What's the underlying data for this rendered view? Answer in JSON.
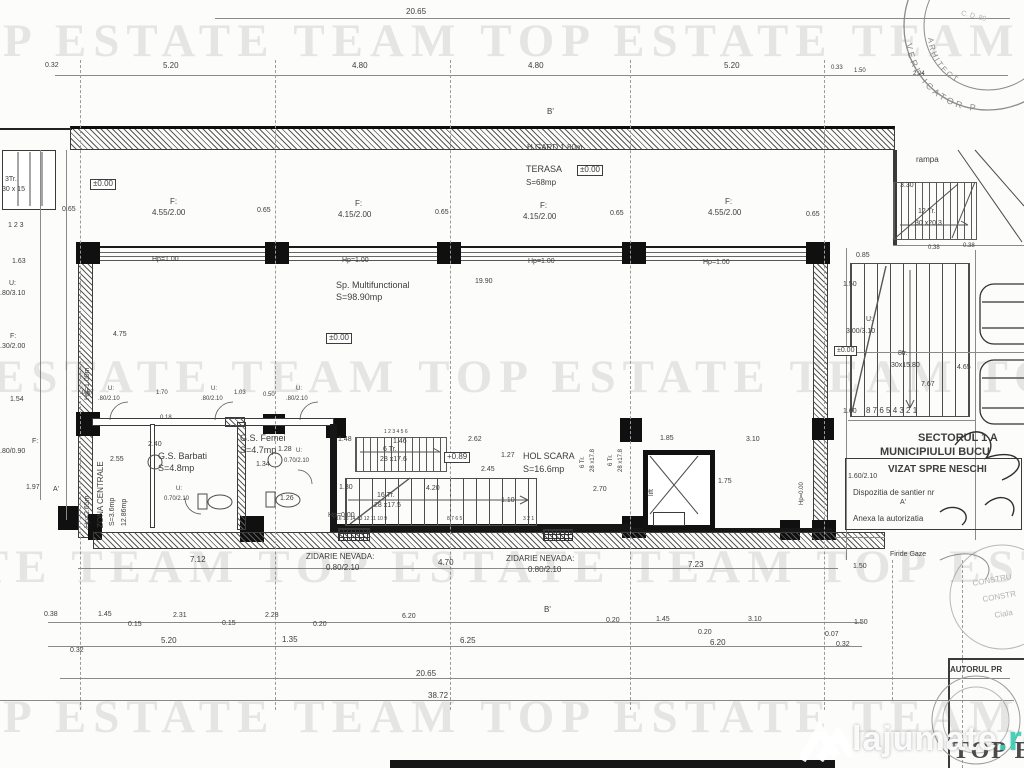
{
  "watermark": {
    "row": "TOP ESTATE TEAM   TOP ESTATE TEAM   TOP ESTATE TEAM",
    "color": "#6e6e6e"
  },
  "footer": {
    "name": "lajumate",
    "tld": ".ro",
    "accent": "#3ad0b8"
  },
  "stamp": {
    "arc1": "VERIFICATOR P",
    "arc2": "ARHITECT",
    "top_note": "C. D. 89"
  },
  "labels": [
    {
      "t": "20.65",
      "x": 406,
      "y": 8
    },
    {
      "t": "0.32",
      "x": 45,
      "y": 62,
      "s": 7
    },
    {
      "t": "5.20",
      "x": 163,
      "y": 62
    },
    {
      "t": "4.80",
      "x": 352,
      "y": 62
    },
    {
      "t": "4.80",
      "x": 528,
      "y": 62
    },
    {
      "t": "5.20",
      "x": 724,
      "y": 62
    },
    {
      "t": "0.33",
      "x": 831,
      "y": 65,
      "s": 6
    },
    {
      "t": "1.50",
      "x": 854,
      "y": 68,
      "s": 6
    },
    {
      "t": "2.24",
      "x": 913,
      "y": 71,
      "s": 6
    },
    {
      "t": "B'",
      "x": 547,
      "y": 108,
      "n": "section-marker-b"
    },
    {
      "t": "H GARD 1.80m",
      "x": 527,
      "y": 144,
      "n": "label-h-gard"
    },
    {
      "t": "TERASA",
      "x": 526,
      "y": 165,
      "s": 9,
      "n": "room-label-terasa"
    },
    {
      "t": "±0.00",
      "x": 577,
      "y": 165,
      "b": 1
    },
    {
      "t": "S=68mp",
      "x": 526,
      "y": 179
    },
    {
      "t": "rampa",
      "x": 916,
      "y": 156,
      "n": "room-label-rampa"
    },
    {
      "t": "3.30",
      "x": 900,
      "y": 182,
      "s": 7
    },
    {
      "t": "12 Tr.",
      "x": 918,
      "y": 208,
      "s": 7
    },
    {
      "t": "30 x20.3",
      "x": 915,
      "y": 220,
      "s": 7
    },
    {
      "t": "0.38",
      "x": 928,
      "y": 245,
      "s": 6
    },
    {
      "t": "0.38",
      "x": 963,
      "y": 243,
      "s": 6
    },
    {
      "t": "3Tr.",
      "x": 5,
      "y": 176,
      "s": 7
    },
    {
      "t": "30 x 15",
      "x": 2,
      "y": 186,
      "s": 7
    },
    {
      "t": "1  2  3",
      "x": 8,
      "y": 222,
      "s": 7,
      "n": "grid-axis-numbers"
    },
    {
      "t": "1.63",
      "x": 12,
      "y": 258,
      "s": 7
    },
    {
      "t": "±0.00",
      "x": 90,
      "y": 179,
      "b": 1
    },
    {
      "t": "U:",
      "x": 9,
      "y": 280,
      "s": 7
    },
    {
      "t": ".80/3.10",
      "x": 0,
      "y": 290,
      "s": 7
    },
    {
      "t": "F:",
      "x": 10,
      "y": 333,
      "s": 7
    },
    {
      "t": ".30/2.00",
      "x": 0,
      "y": 343,
      "s": 7
    },
    {
      "t": "1.54",
      "x": 10,
      "y": 396,
      "s": 7
    },
    {
      "t": "F:",
      "x": 32,
      "y": 438,
      "s": 7
    },
    {
      "t": ".80/0.90",
      "x": 0,
      "y": 448,
      "s": 7
    },
    {
      "t": "1.97",
      "x": 26,
      "y": 484,
      "s": 7
    },
    {
      "t": "A'",
      "x": 53,
      "y": 486,
      "s": 7,
      "n": "section-marker-a"
    },
    {
      "t": "0.65",
      "x": 62,
      "y": 206,
      "s": 7
    },
    {
      "t": "F:",
      "x": 170,
      "y": 198
    },
    {
      "t": "4.55/2.00",
      "x": 152,
      "y": 209
    },
    {
      "t": "0.65",
      "x": 257,
      "y": 207,
      "s": 7
    },
    {
      "t": "F:",
      "x": 355,
      "y": 200
    },
    {
      "t": "4.15/2.00",
      "x": 338,
      "y": 211
    },
    {
      "t": "0.65",
      "x": 435,
      "y": 209,
      "s": 7
    },
    {
      "t": "F:",
      "x": 540,
      "y": 202
    },
    {
      "t": "4.15/2.00",
      "x": 523,
      "y": 213
    },
    {
      "t": "0.65",
      "x": 610,
      "y": 210,
      "s": 7
    },
    {
      "t": "F:",
      "x": 725,
      "y": 198
    },
    {
      "t": "4.55/2.00",
      "x": 708,
      "y": 209
    },
    {
      "t": "0.65",
      "x": 806,
      "y": 211,
      "s": 7
    },
    {
      "t": "Hp=1.00",
      "x": 152,
      "y": 256,
      "s": 7
    },
    {
      "t": "Hp=1.00",
      "x": 342,
      "y": 257,
      "s": 7
    },
    {
      "t": "Hp=1.00",
      "x": 528,
      "y": 258,
      "s": 7
    },
    {
      "t": "Hp=1.00",
      "x": 703,
      "y": 259,
      "s": 7
    },
    {
      "t": "19.90",
      "x": 475,
      "y": 278,
      "s": 7
    },
    {
      "t": "Sp. Multifunctional",
      "x": 336,
      "y": 281,
      "s": 9,
      "n": "room-label-multifunctional"
    },
    {
      "t": "S=98.90mp",
      "x": 336,
      "y": 293,
      "s": 9
    },
    {
      "t": "±0.00",
      "x": 326,
      "y": 333,
      "b": 1
    },
    {
      "t": "4.75",
      "x": 113,
      "y": 331,
      "s": 7
    },
    {
      "t": "Hp=1.00m",
      "x": 84,
      "y": 400,
      "r": -90,
      "s": 7
    },
    {
      "t": "0.85",
      "x": 856,
      "y": 252,
      "s": 7
    },
    {
      "t": "1.50",
      "x": 843,
      "y": 281,
      "s": 7
    },
    {
      "t": "U:",
      "x": 866,
      "y": 316,
      "s": 7
    },
    {
      "t": "3.00/3.10",
      "x": 846,
      "y": 328,
      "s": 7
    },
    {
      "t": "±0.00",
      "x": 834,
      "y": 346,
      "b": 1,
      "s": 7
    },
    {
      "t": "8tr.",
      "x": 898,
      "y": 350,
      "s": 7
    },
    {
      "t": "30x15.80",
      "x": 891,
      "y": 362,
      "s": 7
    },
    {
      "t": "4.65",
      "x": 957,
      "y": 364,
      "s": 7
    },
    {
      "t": "7.67",
      "x": 921,
      "y": 381,
      "s": 7
    },
    {
      "t": "1.60",
      "x": 843,
      "y": 408,
      "s": 7
    },
    {
      "t": "8 7 6  5 4 3 2 1",
      "x": 866,
      "y": 407,
      "n": "stair-tread-numbers"
    },
    {
      "t": "0.67",
      "x": 82,
      "y": 390,
      "s": 6
    },
    {
      "t": "U:",
      "x": 108,
      "y": 386,
      "s": 6
    },
    {
      "t": ".80/2.10",
      "x": 98,
      "y": 396,
      "s": 6
    },
    {
      "t": "1.70",
      "x": 156,
      "y": 390,
      "s": 6
    },
    {
      "t": "U:",
      "x": 211,
      "y": 386,
      "s": 6
    },
    {
      "t": ".80/2.10",
      "x": 201,
      "y": 396,
      "s": 6
    },
    {
      "t": "1.03",
      "x": 234,
      "y": 390,
      "s": 6
    },
    {
      "t": "0.50",
      "x": 263,
      "y": 392,
      "s": 6
    },
    {
      "t": "U:",
      "x": 296,
      "y": 386,
      "s": 6
    },
    {
      "t": ".80/2.10",
      "x": 286,
      "y": 396,
      "s": 6
    },
    {
      "t": "0.18",
      "x": 160,
      "y": 415,
      "s": 6
    },
    {
      "t": "2.40",
      "x": 148,
      "y": 441,
      "s": 7
    },
    {
      "t": "2.55",
      "x": 110,
      "y": 456,
      "s": 7
    },
    {
      "t": "G.S. Barbati",
      "x": 158,
      "y": 452,
      "s": 9,
      "n": "room-label-gs-barbati"
    },
    {
      "t": "S=4.8mp",
      "x": 158,
      "y": 464,
      "s": 9
    },
    {
      "t": "G.S. Femei",
      "x": 240,
      "y": 434,
      "s": 9,
      "n": "room-label-gs-femei"
    },
    {
      "t": "S=4.7mp",
      "x": 240,
      "y": 446,
      "s": 9
    },
    {
      "t": "1.28",
      "x": 278,
      "y": 446,
      "s": 7
    },
    {
      "t": "1.34",
      "x": 256,
      "y": 461,
      "s": 7
    },
    {
      "t": "U:",
      "x": 296,
      "y": 448,
      "s": 6
    },
    {
      "t": "0.70/2.10",
      "x": 284,
      "y": 458,
      "s": 6
    },
    {
      "t": "Hp=2.65m",
      "x": 84,
      "y": 528,
      "r": -90,
      "s": 7
    },
    {
      "t": "ZONA CENTRALE",
      "x": 97,
      "y": 528,
      "r": -90,
      "n": "room-label-zona-centrala"
    },
    {
      "t": "S=3.6mp",
      "x": 109,
      "y": 526,
      "r": -90,
      "s": 7
    },
    {
      "t": "12.86mp",
      "x": 121,
      "y": 526,
      "r": -90,
      "s": 7
    },
    {
      "t": "U:",
      "x": 176,
      "y": 486,
      "s": 6
    },
    {
      "t": "0.70/2.10",
      "x": 164,
      "y": 496,
      "s": 6
    },
    {
      "t": "1.26",
      "x": 280,
      "y": 495,
      "s": 7
    },
    {
      "t": "1.48",
      "x": 338,
      "y": 436,
      "s": 7
    },
    {
      "t": "1 2 3 4 5 6",
      "x": 384,
      "y": 430,
      "s": 5
    },
    {
      "t": "1.46",
      "x": 393,
      "y": 438,
      "s": 7
    },
    {
      "t": "6 Tr.",
      "x": 383,
      "y": 446,
      "s": 7
    },
    {
      "t": "28 x17.6",
      "x": 380,
      "y": 456,
      "s": 7
    },
    {
      "t": "+0.89",
      "x": 444,
      "y": 452,
      "b": 1
    },
    {
      "t": "2.62",
      "x": 468,
      "y": 436,
      "s": 7
    },
    {
      "t": "1.27",
      "x": 501,
      "y": 452,
      "s": 7
    },
    {
      "t": "HOL SCARA",
      "x": 523,
      "y": 452,
      "s": 9,
      "n": "room-label-hol-scara"
    },
    {
      "t": "2.45",
      "x": 481,
      "y": 466,
      "s": 7
    },
    {
      "t": "S=16.6mp",
      "x": 523,
      "y": 465,
      "s": 9
    },
    {
      "t": "1.30",
      "x": 339,
      "y": 484,
      "s": 7
    },
    {
      "t": "4.20",
      "x": 426,
      "y": 485,
      "s": 7
    },
    {
      "t": "16 Tr.",
      "x": 377,
      "y": 492,
      "s": 7
    },
    {
      "t": "28 x17.5",
      "x": 374,
      "y": 502,
      "s": 7
    },
    {
      "t": "1.10",
      "x": 501,
      "y": 497,
      "s": 7
    },
    {
      "t": "2.70",
      "x": 593,
      "y": 486,
      "s": 7
    },
    {
      "t": "Hp=0.00",
      "x": 328,
      "y": 512,
      "s": 7
    },
    {
      "t": "16 15 14 13 12 11 10 9",
      "x": 336,
      "y": 517,
      "s": 5,
      "n": "stair-tread-numbers"
    },
    {
      "t": "8 7 6 5",
      "x": 447,
      "y": 517,
      "s": 5
    },
    {
      "t": "3 2 1",
      "x": 523,
      "y": 517,
      "s": 5
    },
    {
      "t": "6 Tr.",
      "x": 580,
      "y": 468,
      "r": -90,
      "s": 6
    },
    {
      "t": "28 x17.8",
      "x": 590,
      "y": 472,
      "r": -90,
      "s": 6
    },
    {
      "t": "6 Tr.",
      "x": 608,
      "y": 466,
      "r": -90,
      "s": 6
    },
    {
      "t": "28 x17.8",
      "x": 618,
      "y": 472,
      "r": -90,
      "s": 6
    },
    {
      "t": "1.85",
      "x": 660,
      "y": 435,
      "s": 7
    },
    {
      "t": "3.10",
      "x": 746,
      "y": 436,
      "s": 7
    },
    {
      "t": "1.75",
      "x": 718,
      "y": 478,
      "s": 7
    },
    {
      "t": "lift",
      "x": 648,
      "y": 496,
      "r": -90,
      "s": 7,
      "n": "room-label-lift"
    },
    {
      "t": "Hp=0.00",
      "x": 799,
      "y": 505,
      "r": -90,
      "s": 6
    },
    {
      "t": "SECTORUL 1 A",
      "x": 918,
      "y": 432,
      "s": 11,
      "w": 700,
      "n": "stamp-text-sectorul"
    },
    {
      "t": "MUNICIPIULUI BUCU",
      "x": 880,
      "y": 446,
      "s": 11,
      "w": 700,
      "n": "stamp-text-municipiu"
    },
    {
      "t": "VIZAT SPRE NESCHI",
      "x": 888,
      "y": 464,
      "s": 10,
      "w": 700,
      "n": "stamp-text-vizat"
    },
    {
      "t": "1.60/2.10",
      "x": 848,
      "y": 473,
      "s": 7
    },
    {
      "t": "Dispozitia de santier nr",
      "x": 853,
      "y": 489,
      "n": "stamp-text-dispozitia"
    },
    {
      "t": "A'",
      "x": 900,
      "y": 499,
      "s": 7
    },
    {
      "t": "Anexa la autorizatia",
      "x": 853,
      "y": 515,
      "n": "stamp-text-anexa"
    },
    {
      "t": "Firide Gaze",
      "x": 890,
      "y": 551,
      "s": 7
    },
    {
      "t": "ZIDARIE NEVADA:",
      "x": 306,
      "y": 553,
      "n": "wall-note-zidarie"
    },
    {
      "t": "0.80/2.10",
      "x": 326,
      "y": 564
    },
    {
      "t": "7.12",
      "x": 190,
      "y": 556
    },
    {
      "t": "4.70",
      "x": 438,
      "y": 559
    },
    {
      "t": "ZIDARIE NEVADA:",
      "x": 506,
      "y": 555,
      "n": "wall-note-zidarie"
    },
    {
      "t": "0.80/2.10",
      "x": 528,
      "y": 566
    },
    {
      "t": "7.23",
      "x": 688,
      "y": 561
    },
    {
      "t": "1.50",
      "x": 853,
      "y": 563,
      "s": 7
    },
    {
      "t": "B'",
      "x": 544,
      "y": 606,
      "n": "section-marker-b"
    },
    {
      "t": "0.38",
      "x": 44,
      "y": 611,
      "s": 7
    },
    {
      "t": "1.45",
      "x": 98,
      "y": 611,
      "s": 7
    },
    {
      "t": "0.15",
      "x": 128,
      "y": 621,
      "s": 7
    },
    {
      "t": "2.31",
      "x": 173,
      "y": 612,
      "s": 7
    },
    {
      "t": "0.15",
      "x": 222,
      "y": 620,
      "s": 7
    },
    {
      "t": "2.28",
      "x": 265,
      "y": 612,
      "s": 7
    },
    {
      "t": "0.20",
      "x": 313,
      "y": 621,
      "s": 7
    },
    {
      "t": "6.20",
      "x": 402,
      "y": 613,
      "s": 7
    },
    {
      "t": "0.20",
      "x": 606,
      "y": 617,
      "s": 7
    },
    {
      "t": "1.45",
      "x": 656,
      "y": 616,
      "s": 7
    },
    {
      "t": "0.20",
      "x": 698,
      "y": 629,
      "s": 7
    },
    {
      "t": "3.10",
      "x": 748,
      "y": 616,
      "s": 7
    },
    {
      "t": "1.50",
      "x": 854,
      "y": 619,
      "s": 7
    },
    {
      "t": "0.07",
      "x": 825,
      "y": 631,
      "s": 7
    },
    {
      "t": "0.32",
      "x": 836,
      "y": 641,
      "s": 7
    },
    {
      "t": "0.32",
      "x": 70,
      "y": 647,
      "s": 7
    },
    {
      "t": "5.20",
      "x": 161,
      "y": 637
    },
    {
      "t": "1.35",
      "x": 282,
      "y": 636
    },
    {
      "t": "6.25",
      "x": 460,
      "y": 637
    },
    {
      "t": "6.20",
      "x": 710,
      "y": 639
    },
    {
      "t": "20.65",
      "x": 416,
      "y": 670
    },
    {
      "t": "38.72",
      "x": 428,
      "y": 692
    },
    {
      "t": "AUTORUL PR",
      "x": 950,
      "y": 666,
      "w": 700,
      "n": "stamp-text-autorul"
    },
    {
      "t": "C. D. 89",
      "x": 962,
      "y": 10,
      "r": 14,
      "f": 1,
      "s": 7
    },
    {
      "t": "CONSTRU",
      "x": 972,
      "y": 580,
      "r": -10,
      "f": 1
    },
    {
      "t": "CONSTR",
      "x": 982,
      "y": 596,
      "r": -10,
      "f": 1
    },
    {
      "t": "Ciala",
      "x": 994,
      "y": 612,
      "r": -10,
      "f": 1
    },
    {
      "t": "TOP E",
      "x": 953,
      "y": 738,
      "s": 24,
      "w": 700,
      "serif": 1,
      "n": "corner-stamp-mark"
    }
  ]
}
